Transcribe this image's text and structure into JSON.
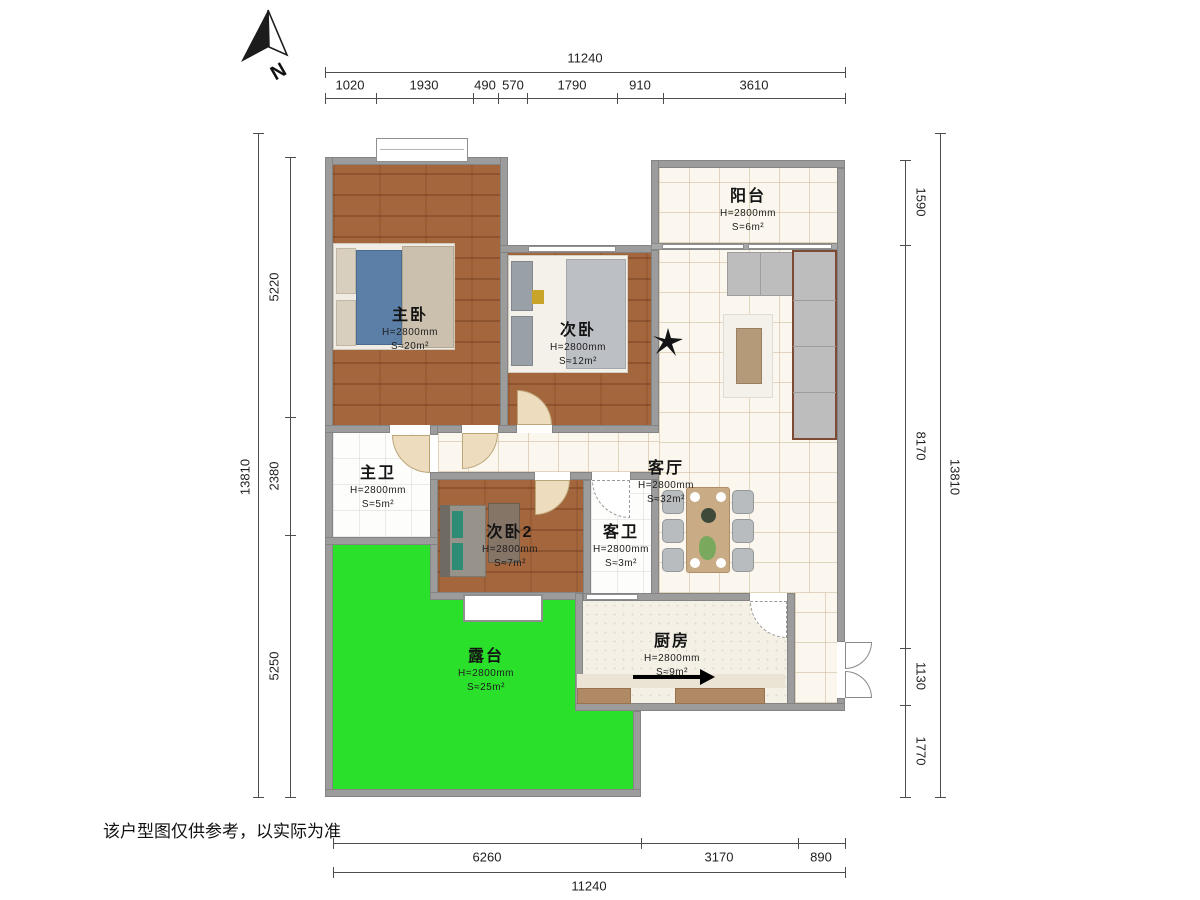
{
  "compass": {
    "label": "N"
  },
  "rooms": {
    "master": {
      "name": "主卧",
      "h": "H=2800mm",
      "s": "S≈20m²"
    },
    "bed2": {
      "name": "次卧",
      "h": "H=2800mm",
      "s": "S≈12m²"
    },
    "balcony": {
      "name": "阳台",
      "h": "H=2800mm",
      "s": "S=6m²"
    },
    "mbath": {
      "name": "主卫",
      "h": "H=2800mm",
      "s": "S=5m²"
    },
    "bed3": {
      "name": "次卧2",
      "h": "H=2800mm",
      "s": "S≈7m²"
    },
    "living": {
      "name": "客厅",
      "h": "H=2800mm",
      "s": "S≈32m²"
    },
    "gbath": {
      "name": "客卫",
      "h": "H=2800mm",
      "s": "S≈3m²"
    },
    "kitchen": {
      "name": "厨房",
      "h": "H=2800mm",
      "s": "S≈9m²"
    },
    "terrace": {
      "name": "露台",
      "h": "H=2800mm",
      "s": "S≈25m²"
    }
  },
  "dims": {
    "top": {
      "total": "11240",
      "segments": [
        "1020",
        "1930",
        "490",
        "570",
        "1790",
        "910",
        "3610"
      ]
    },
    "left": {
      "total": "13810",
      "segments": [
        "5220",
        "2380",
        "5250"
      ]
    },
    "right": {
      "total": "13810",
      "segments": [
        "1590",
        "8170",
        "1130",
        "1770"
      ]
    },
    "bottom": {
      "total": "11240",
      "segments": [
        "6260",
        "3170",
        "890"
      ]
    }
  },
  "footer": {
    "disclaimer": "该户型图仅供参考，以实际为准"
  },
  "colors": {
    "terrace_green": "#2ae02a",
    "wood_floor": "#a4663c",
    "wall_gray": "#9c9c9c",
    "tile_cream": "#fbf7ee",
    "counter_brown": "#b08a64",
    "door_tan": "#eedcbf"
  }
}
